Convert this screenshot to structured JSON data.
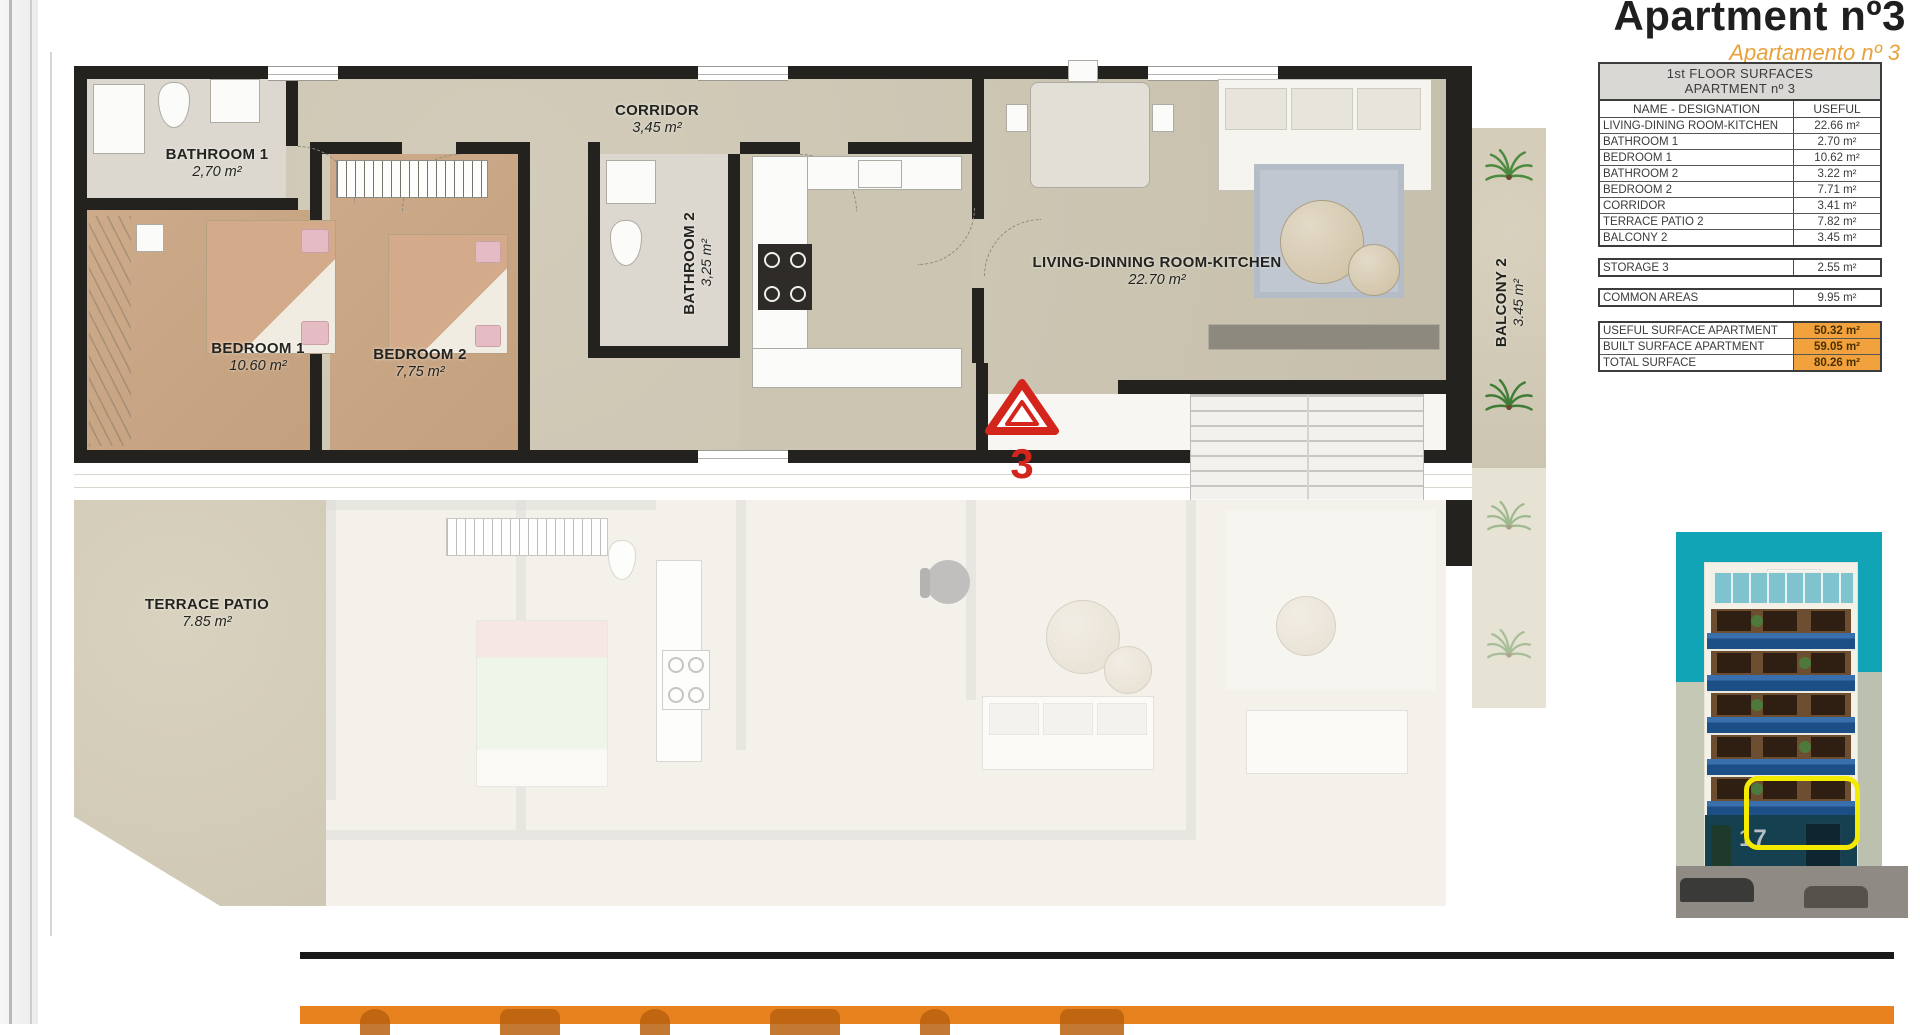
{
  "page": {
    "title": "Apartment nº3",
    "subtitle": "Apartamento nº 3"
  },
  "plan": {
    "unit_marker": "3",
    "rooms": {
      "bathroom1": {
        "name": "BATHROOM 1",
        "area": "2,70 m²"
      },
      "corridor": {
        "name": "CORRIDOR",
        "area": "3,45 m²"
      },
      "bedroom1": {
        "name": "BEDROOM 1",
        "area": "10.60 m²"
      },
      "bedroom2": {
        "name": "BEDROOM 2",
        "area": "7,75 m²"
      },
      "bathroom2": {
        "name": "BATHROOM 2",
        "area": "3,25 m²"
      },
      "living": {
        "name": "LIVING-DINNING ROOM-KITCHEN",
        "area": "22.70 m²"
      },
      "terrace": {
        "name": "TERRACE  PATIO",
        "area": "7.85 m²"
      },
      "balcony2": {
        "name": "BALCONY 2",
        "area": "3.45 m²"
      }
    }
  },
  "surfaces_table": {
    "title_line1": "1st FLOOR SURFACES",
    "title_line2": "APARTMENT nº 3",
    "columns": [
      "NAME - DESIGNATION",
      "USEFUL"
    ],
    "rows": [
      {
        "name": "LIVING-DINING ROOM-KITCHEN",
        "value": "22.66 m²"
      },
      {
        "name": "BATHROOM 1",
        "value": "2.70 m²"
      },
      {
        "name": "BEDROOM 1",
        "value": "10.62 m²"
      },
      {
        "name": "BATHROOM 2",
        "value": "3.22 m²"
      },
      {
        "name": "BEDROOM 2",
        "value": "7.71 m²"
      },
      {
        "name": "CORRIDOR",
        "value": "3.41 m²"
      },
      {
        "name": "TERRACE PATIO 2",
        "value": "7.82 m²"
      },
      {
        "name": "BALCONY 2",
        "value": "3.45 m²"
      }
    ],
    "storage_row": {
      "name": "STORAGE 3",
      "value": "2.55 m²"
    },
    "common_row": {
      "name": "COMMON AREAS",
      "value": "9.95 m²"
    },
    "totals": [
      {
        "name": "USEFUL SURFACE APARTMENT",
        "value": "50.32 m²"
      },
      {
        "name": "BUILT SURFACE APARTMENT",
        "value": "59.05 m²"
      },
      {
        "name": "TOTAL SURFACE",
        "value": "80.26 m²"
      }
    ]
  },
  "building": {
    "street_number": "17"
  },
  "colors": {
    "accent_orange": "#F2A23C",
    "subtitle_orange": "#E9A23B",
    "footer_orange": "#E8821E",
    "marker_red": "#D3251C",
    "sky_teal": "#11A4B7",
    "balcony_blue": "#1D4F87",
    "highlight_yellow": "#F3EA00"
  }
}
